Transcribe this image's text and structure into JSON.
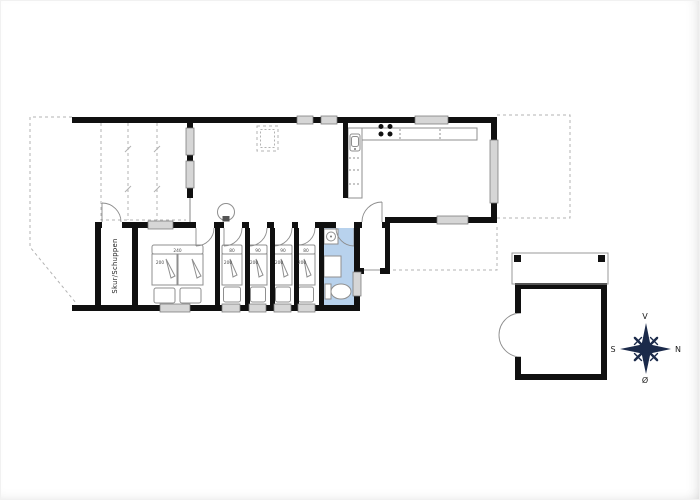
{
  "floor_plan": {
    "shed_label": "Skur/Schuppen",
    "double_bed": {
      "width": "240",
      "length": "200"
    },
    "single_beds": [
      {
        "width": "80",
        "length": "200"
      },
      {
        "width": "90",
        "length": "200"
      },
      {
        "width": "90",
        "length": "200"
      },
      {
        "width": "80",
        "length": "200"
      }
    ],
    "compass": {
      "v": "V",
      "n": "N",
      "s": "S",
      "o": "Ø"
    },
    "colors": {
      "wall": "#101010",
      "bathroom_fill": "#b8d2ed",
      "window_fill": "#d6d6d6",
      "dashed_line": "#b3b3b3",
      "furniture_line": "#8f8f8f",
      "compass": "#1b2a4a"
    }
  }
}
